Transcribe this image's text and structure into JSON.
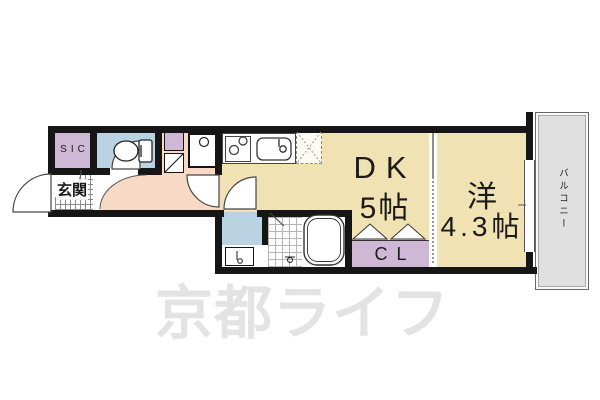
{
  "floor_plan": {
    "rooms": {
      "dk": {
        "label": "DK",
        "size": "5帖"
      },
      "western": {
        "label": "洋",
        "size": "4.3帖"
      },
      "closet": {
        "label": "CL"
      },
      "shoe_closet": {
        "label": "SIC"
      },
      "entrance": {
        "label": "玄関"
      },
      "balcony": {
        "label": "バルコニー"
      }
    },
    "fixtures": [
      "toilet",
      "washer-pan",
      "stove",
      "kitchen-sink",
      "refrigerator-space",
      "washbasin-vanity",
      "bathtub",
      "shower-area",
      "folding-closet-doors",
      "sliding-partition",
      "balcony-window",
      "entrance-door",
      "interior-doors"
    ],
    "colors": {
      "room_tan": "#f1e2b4",
      "hallway_pink": "#f8d9c5",
      "wet_area_blue": "#b9d3e2",
      "closet_purple": "#cfb7d6",
      "balcony_gray": "#e0e0e0",
      "wall_black": "#161616",
      "watermark_gray": "#e3e3e3"
    }
  },
  "watermark": {
    "text": "京都ライフ"
  }
}
